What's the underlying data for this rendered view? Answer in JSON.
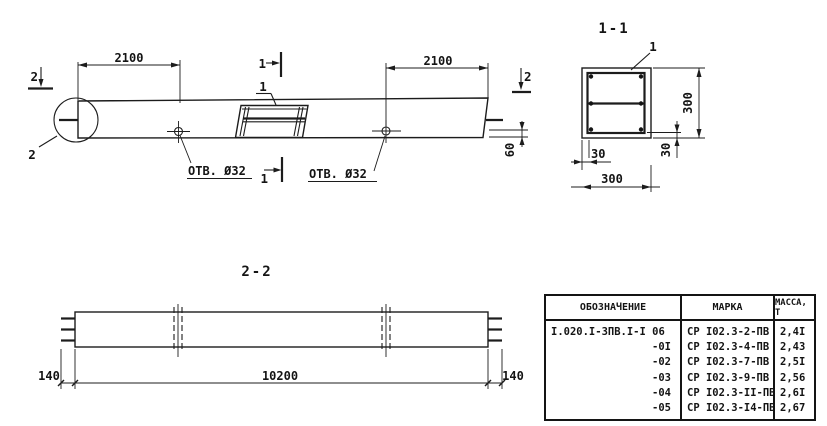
{
  "colors": {
    "ink": "#141414",
    "paper": "#ffffff"
  },
  "elevation": {
    "dim_left": "2100",
    "dim_right": "2100",
    "dim_end": "60",
    "note_left": "ОТВ. Ø32",
    "note_right": "ОТВ. Ø32",
    "marker_left": "2",
    "marker_right": "2",
    "marker_top": "1",
    "marker_bottom": "1",
    "recess_leader": "1",
    "detail_leader": "2"
  },
  "section11": {
    "title": "1-1",
    "rebar_leader": "1",
    "dim_height": "300",
    "dim_width": "300",
    "dim_cover_side": "30",
    "dim_cover_bottom": "30"
  },
  "section22": {
    "title": "2-2",
    "dim_left": "140",
    "dim_length": "10200",
    "dim_right": "140"
  },
  "table": {
    "headers": [
      "ОБОЗНАЧЕНИЕ",
      "МАРКА",
      "МАССА, Т"
    ],
    "rows": [
      {
        "designation": "I.020.I-3ПВ.I-I 06",
        "mark": "СР I02.3-2-ПВ",
        "mass": "2,4I"
      },
      {
        "designation": "-0I",
        "mark": "СР I02.3-4-ПВ",
        "mass": "2,43"
      },
      {
        "designation": "-02",
        "mark": "СР I02.3-7-ПВ",
        "mass": "2,5I"
      },
      {
        "designation": "-03",
        "mark": "СР I02.3-9-ПВ",
        "mass": "2,56"
      },
      {
        "designation": "-04",
        "mark": "СР I02.3-II-ПВ",
        "mass": "2,6I"
      },
      {
        "designation": "-05",
        "mark": "СР I02.3-I4-ПВ",
        "mass": "2,67"
      }
    ]
  }
}
